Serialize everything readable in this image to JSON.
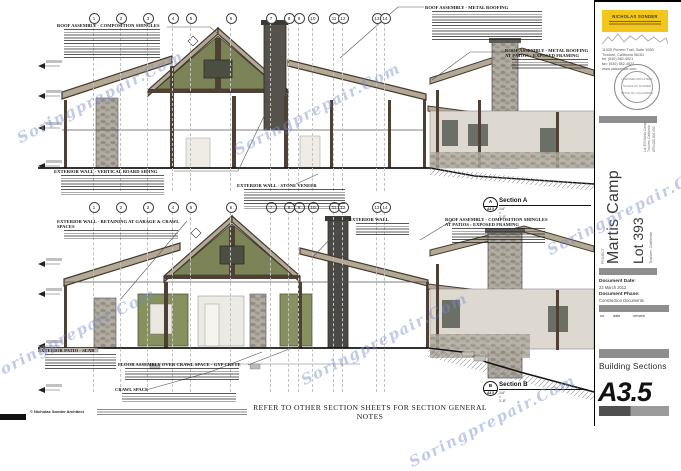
{
  "watermark": {
    "text": "Soringprepair.Com",
    "color": "#7b8cd0"
  },
  "sheet": {
    "footer_note": "REFER TO OTHER SECTION SHEETS FOR SECTION GENERAL NOTES",
    "copyright": "© Nicholas Sonder Architect"
  },
  "grid": {
    "top_row": [
      "1",
      "2",
      "3",
      "4",
      "5",
      "6",
      "7",
      "8",
      "9",
      "10",
      "11",
      "12",
      "13",
      "14"
    ],
    "bottom_row": [
      "1",
      "2",
      "3",
      "4",
      "5",
      "6",
      "7",
      "8",
      "9",
      "10",
      "11",
      "12",
      "13",
      "14"
    ]
  },
  "sections": {
    "a": {
      "label": "Section A",
      "letter": "A",
      "sheet_ref": "A3.5",
      "scale": "1/4\" = 1'-0\""
    },
    "b": {
      "label": "Section B",
      "letter": "B",
      "sheet_ref": "A3.5",
      "scale": "1/4\" = 1'-0\""
    }
  },
  "notes": {
    "roof_comp": "ROOF ASSEMBLY - COMPOSITION SHINGLES",
    "roof_metal": "ROOF ASSEMBLY - METAL ROOFING",
    "roof_metal_patio": "ROOF ASSEMBLY - METAL ROOFING AT PATIOS : EXPOSED FRAMING",
    "wall_siding": "EXTERIOR WALL - VERTICAL BOARD SIDING",
    "wall_stone": "EXTERIOR WALL - STONE VENEER",
    "wall_retaining": "EXTERIOR WALL - RETAINING AT GARAGE & CRAWL SPACES",
    "wall_plain": "EXTERIOR WALL",
    "roof_comp_patio": "ROOF ASSEMBLY - COMPOSITION SHINGLES AT PATIOS : EXPOSED FRAMING",
    "patio_slab": "EXTERIOR PATIO - SLAB",
    "floor_crawl": "FLOOR ASSEMBLY OVER CRAWL SPACE - GYP CRETE",
    "crawl": "CRAWL SPACE"
  },
  "title_block": {
    "firm_name": "NICHOLAS SONDER",
    "address_lines": [
      "11025 Pioneer Trail, Suite 100B",
      "Truckee, California 96161",
      "tel: (530) 582-4521",
      "fax: (530) 582-4522",
      "www.nicksonder.com"
    ],
    "stamp_lines": [
      "LICENSED ARCHITECT",
      "NICHOLAS SONDER",
      "STATE OF CALIFORNIA"
    ],
    "site_lines": [
      "Lot 393 Martis Camp",
      "Truckee, California",
      "APN 000-000-000"
    ],
    "project_label": "PROJECT",
    "project_name": "Martis Camp",
    "project_lot": "Lot 393",
    "project_sub": "Truckee, California",
    "doc_date_label": "Document Date:",
    "doc_date": "23 March 2012",
    "doc_phase_label": "Document Phase:",
    "doc_phase": "Construction Documents",
    "rev_no": "no.",
    "rev_date": "date",
    "rev_remark": "remark",
    "sheet_title": "Building Sections",
    "sheet_number": "A3.5"
  }
}
